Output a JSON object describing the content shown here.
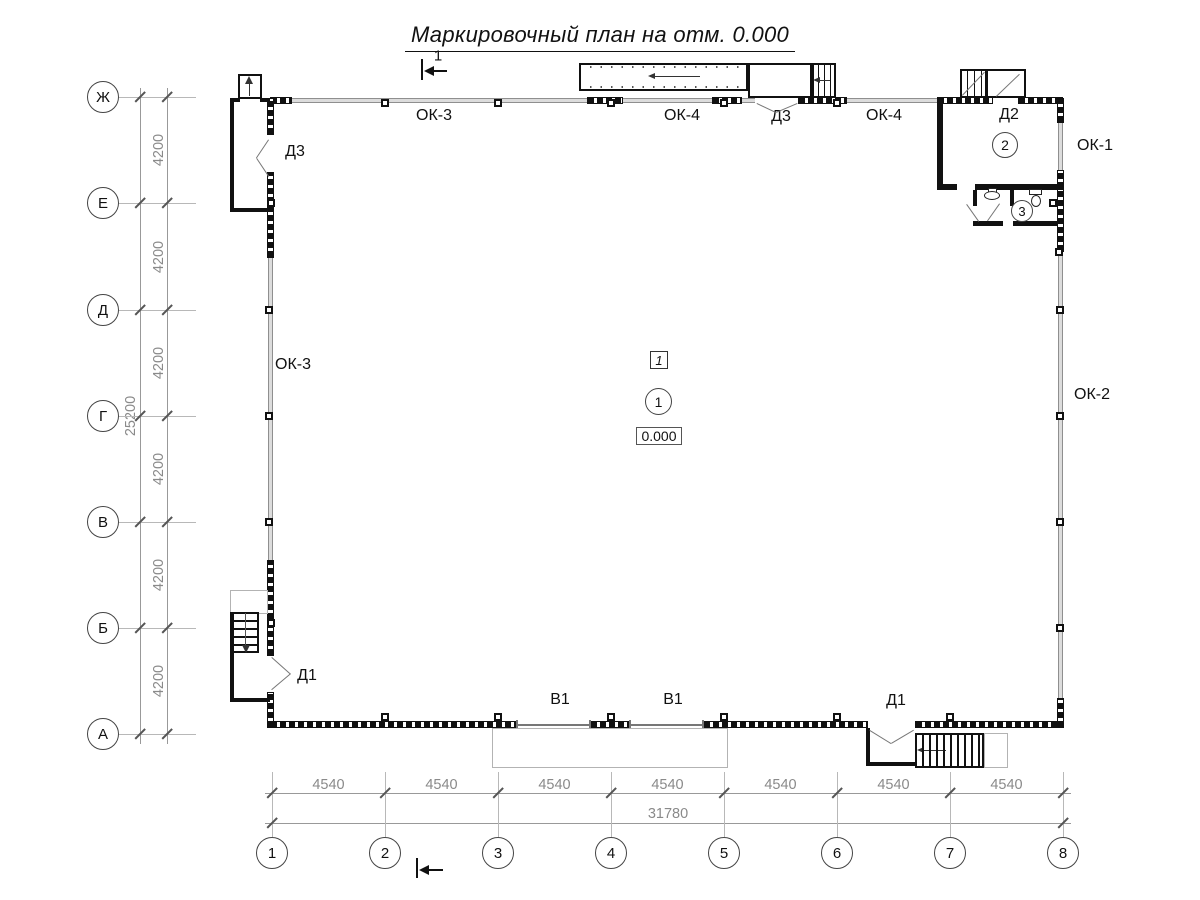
{
  "title": "Маркировочный план на отм. 0.000",
  "section_mark": {
    "label": "1"
  },
  "axes": {
    "horizontal": [
      "Ж",
      "Е",
      "Д",
      "Г",
      "В",
      "Б",
      "А"
    ],
    "vertical": [
      "1",
      "2",
      "3",
      "4",
      "5",
      "6",
      "7",
      "8"
    ]
  },
  "dims": {
    "left_total": "25200",
    "left_segments": [
      "4200",
      "4200",
      "4200",
      "4200",
      "4200",
      "4200"
    ],
    "bottom_total": "31780",
    "bottom_segments": [
      "4540",
      "4540",
      "4540",
      "4540",
      "4540",
      "4540",
      "4540"
    ]
  },
  "marks": {
    "windows": {
      "ok1": "ОК-1",
      "ok2": "ОК-2",
      "ok3_top": "ОК-3",
      "ok3_left": "ОК-3",
      "ok4_a": "ОК-4",
      "ok4_b": "ОК-4"
    },
    "doors": {
      "d3_top": "Д3",
      "d3_left": "Д3",
      "d2": "Д2",
      "d1_left": "Д1",
      "d1_bottom": "Д1"
    },
    "gates": {
      "v1_a": "В1",
      "v1_b": "В1"
    }
  },
  "rooms": {
    "hall": "1",
    "lobby": "2",
    "wc": "3"
  },
  "hall_type_mark": "1",
  "elevation": "0.000"
}
